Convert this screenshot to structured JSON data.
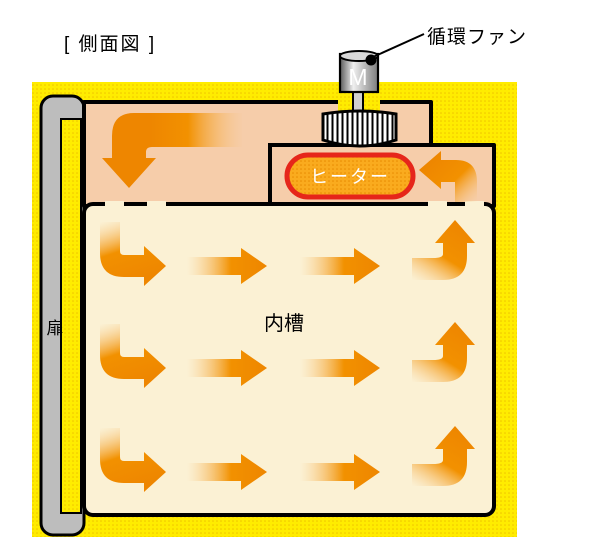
{
  "title": "[ 側面図 ]",
  "labels": {
    "fan": "循環ファン",
    "motor": "M",
    "heater": "ヒーター",
    "inner_chamber": "内槽",
    "door": "扉"
  },
  "colors": {
    "case_yellow": "#FFEC00",
    "case_dot": "#EFC400",
    "plenum_peach": "#F6CDAA",
    "chamber_cream": "#FBF1D4",
    "arrow_orange": "#F29100",
    "heater_fill": "#FAAB1E",
    "heater_dot": "#E88A00",
    "heater_border": "#E6261A",
    "door_gray": "#BDBDBD",
    "outline_black": "#000000"
  }
}
